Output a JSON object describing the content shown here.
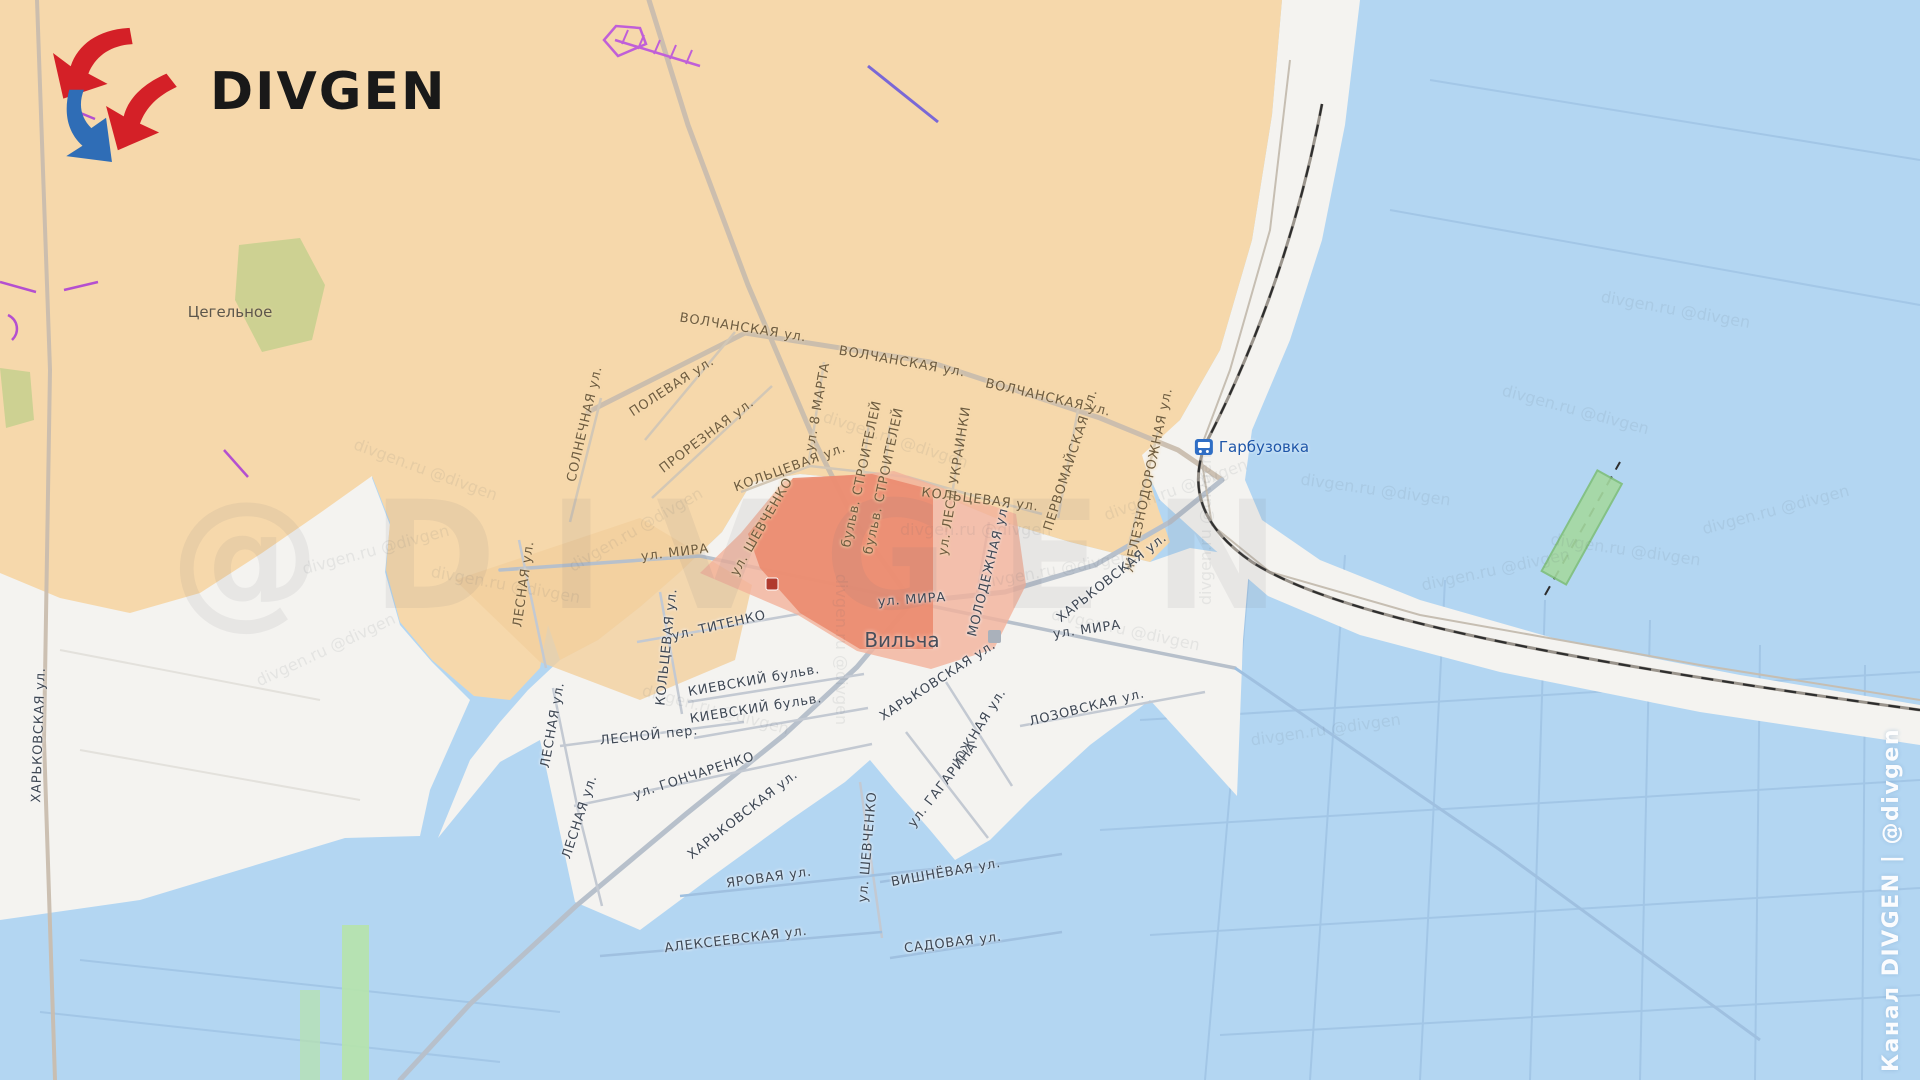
{
  "branding": {
    "logo_text": "DIVGEN",
    "channel_watermark": "Канал DIVGEN | @divgen",
    "watermark_large": "@DIVGEN",
    "watermark_small": "divgen.ru @divgen"
  },
  "colors": {
    "zone_orange": "#f6d8ab",
    "zone_orange_patch": "#f3cf9d",
    "zone_white": "#f4f3f0",
    "zone_blue": "#b3d6f2",
    "advance_red_light": "#f3b19b",
    "advance_red_dark": "#eb8b6f",
    "logo_red": "#d42027",
    "logo_blue": "#2f6db6",
    "station_blue": "#2f6ec5",
    "bridge_green": "#a5d9a0",
    "olive_patch": "#cdd192",
    "violet_marking": "#c05fd8",
    "road_major": "#c9bdae",
    "railway_dash": "#2e2e2e"
  },
  "places": [
    {
      "name": "Цегельное",
      "x": 230,
      "y": 312,
      "z": "o",
      "size": 15
    },
    {
      "name": "Вильча",
      "x": 902,
      "y": 640,
      "z": "w",
      "size": 20
    },
    {
      "name": "Гарбузовка",
      "x": 1252,
      "y": 447,
      "z": "st",
      "size": 15
    }
  ],
  "streets": [
    {
      "label": "ВОЛЧАНСКАЯ ул.",
      "x": 743,
      "y": 328,
      "r": 9,
      "z": "o"
    },
    {
      "label": "ВОЛЧАНСКАЯ ул.",
      "x": 902,
      "y": 362,
      "r": 10,
      "z": "o"
    },
    {
      "label": "ВОЛЧАНСКАЯ ул.",
      "x": 1048,
      "y": 398,
      "r": 13,
      "z": "o"
    },
    {
      "label": "СОЛНЕЧНАЯ ул.",
      "x": 585,
      "y": 424,
      "r": -77,
      "z": "o"
    },
    {
      "label": "ПОЛЕВАЯ ул.",
      "x": 672,
      "y": 387,
      "r": -33,
      "z": "o"
    },
    {
      "label": "ПРОРЕЗНАЯ ул.",
      "x": 707,
      "y": 436,
      "r": -37,
      "z": "o"
    },
    {
      "label": "ул. 8 МАРТА",
      "x": 818,
      "y": 407,
      "r": -80,
      "z": "o"
    },
    {
      "label": "бульв. СТРОИТЕЛЕЙ",
      "x": 862,
      "y": 474,
      "r": -78,
      "z": "o"
    },
    {
      "label": "бульв. СТРОИТЕЛЕЙ",
      "x": 884,
      "y": 481,
      "r": -78,
      "z": "o"
    },
    {
      "label": "ул. ЛЕСИ УКРАИНКИ",
      "x": 955,
      "y": 481,
      "r": -81,
      "z": "o"
    },
    {
      "label": "КОЛЬЦЕВАЯ ул.",
      "x": 790,
      "y": 468,
      "r": -20,
      "z": "o"
    },
    {
      "label": "КОЛЬЦЕВАЯ ул.",
      "x": 980,
      "y": 500,
      "r": 7,
      "z": "o"
    },
    {
      "label": "ПЕРВОМАЙСКАЯ ул.",
      "x": 1071,
      "y": 460,
      "r": -72,
      "z": "o"
    },
    {
      "label": "ЖЕЛЕЗНОДОРОЖНАЯ ул.",
      "x": 1149,
      "y": 480,
      "r": -78,
      "z": "o"
    },
    {
      "label": "ул. ШЕВЧЕНКО",
      "x": 762,
      "y": 527,
      "r": -60,
      "z": "o"
    },
    {
      "label": "ул. МИРА",
      "x": 675,
      "y": 553,
      "r": -7,
      "z": "o"
    },
    {
      "label": "ул. МИРА",
      "x": 912,
      "y": 600,
      "r": -4,
      "z": "w"
    },
    {
      "label": "ул. МИРА",
      "x": 1087,
      "y": 630,
      "r": -8,
      "z": "w"
    },
    {
      "label": "МОЛОДЕЖНАЯ ул.",
      "x": 989,
      "y": 570,
      "r": -76,
      "z": "w"
    },
    {
      "label": "ХАРЬКОВСКАЯ ул.",
      "x": 1112,
      "y": 578,
      "r": -38,
      "z": "w"
    },
    {
      "label": "ХАРЬКОВСКАЯ ул.",
      "x": 938,
      "y": 681,
      "r": -33,
      "z": "w"
    },
    {
      "label": "ХАРЬКОВСКАЯ ул.",
      "x": 743,
      "y": 815,
      "r": -38,
      "z": "w"
    },
    {
      "label": "ХАРЬКОВСКАЯ ул.",
      "x": 39,
      "y": 735,
      "r": -88,
      "z": "w"
    },
    {
      "label": "ул. ТИТЕНКО",
      "x": 719,
      "y": 626,
      "r": -13,
      "z": "w"
    },
    {
      "label": "КОЛЬЦЕВАЯ ул.",
      "x": 667,
      "y": 647,
      "r": -84,
      "z": "w"
    },
    {
      "label": "ЛЕСНАЯ ул.",
      "x": 524,
      "y": 584,
      "r": -82,
      "z": "o"
    },
    {
      "label": "ЛЕСНАЯ ул.",
      "x": 553,
      "y": 725,
      "r": -80,
      "z": "w"
    },
    {
      "label": "ЛЕСНАЯ ул.",
      "x": 580,
      "y": 817,
      "r": -72,
      "z": "w"
    },
    {
      "label": "КИЕВСКИЙ бульв.",
      "x": 754,
      "y": 681,
      "r": -10,
      "z": "w"
    },
    {
      "label": "КИЕВСКИЙ бульв.",
      "x": 756,
      "y": 709,
      "r": -9,
      "z": "w"
    },
    {
      "label": "ЛЕСНОЙ пер.",
      "x": 649,
      "y": 736,
      "r": -6,
      "z": "w"
    },
    {
      "label": "ул. ГОНЧАРЕНКО",
      "x": 694,
      "y": 776,
      "r": -18,
      "z": "w"
    },
    {
      "label": "ЮЖНАЯ ул.",
      "x": 980,
      "y": 727,
      "r": -58,
      "z": "w"
    },
    {
      "label": "ул. ГАГАРИНА",
      "x": 943,
      "y": 785,
      "r": -52,
      "z": "w"
    },
    {
      "label": "ЛОЗОВСКАЯ ул.",
      "x": 1087,
      "y": 708,
      "r": -14,
      "z": "w"
    },
    {
      "label": "ул. ШЕВЧЕНКО",
      "x": 868,
      "y": 847,
      "r": -85,
      "z": "w"
    },
    {
      "label": "ЯРОВАЯ ул.",
      "x": 769,
      "y": 878,
      "r": -8,
      "z": "w"
    },
    {
      "label": "ВИШНЁВАЯ ул.",
      "x": 946,
      "y": 873,
      "r": -10,
      "z": "w"
    },
    {
      "label": "АЛЕКСЕЕВСКАЯ ул.",
      "x": 736,
      "y": 940,
      "r": -7,
      "z": "w"
    },
    {
      "label": "САДОВАЯ ул.",
      "x": 953,
      "y": 943,
      "r": -7,
      "z": "w"
    }
  ]
}
